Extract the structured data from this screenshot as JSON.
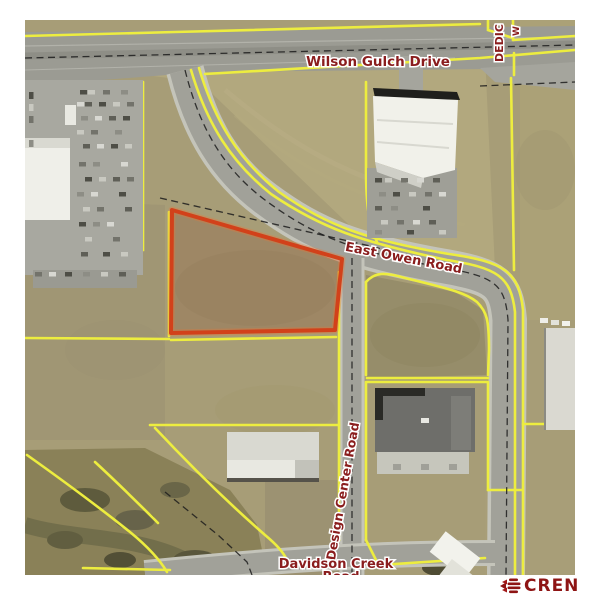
{
  "map": {
    "road_labels": {
      "wilson_gulch_drive": "Wilson Gulch Drive",
      "east_owen_road": "East Owen Road",
      "design_center_road": "Design Center Road",
      "davidson_creek_line1": "Davidson Creek",
      "davidson_creek_line2": "Road",
      "dedication_partial": "DEDIC",
      "dedication_partial_2": "W"
    },
    "highlight": {
      "outline_color": "#d2411a"
    }
  },
  "branding": {
    "name": "CREN"
  },
  "colors": {
    "page_bg": "#ffffff",
    "terrain": "#a79d77",
    "parcel_line_yellow": "#eded3f",
    "road_label_maroon": "#8a1d1d",
    "highlight_red": "#d2411a",
    "logo_red": "#8e1414"
  }
}
